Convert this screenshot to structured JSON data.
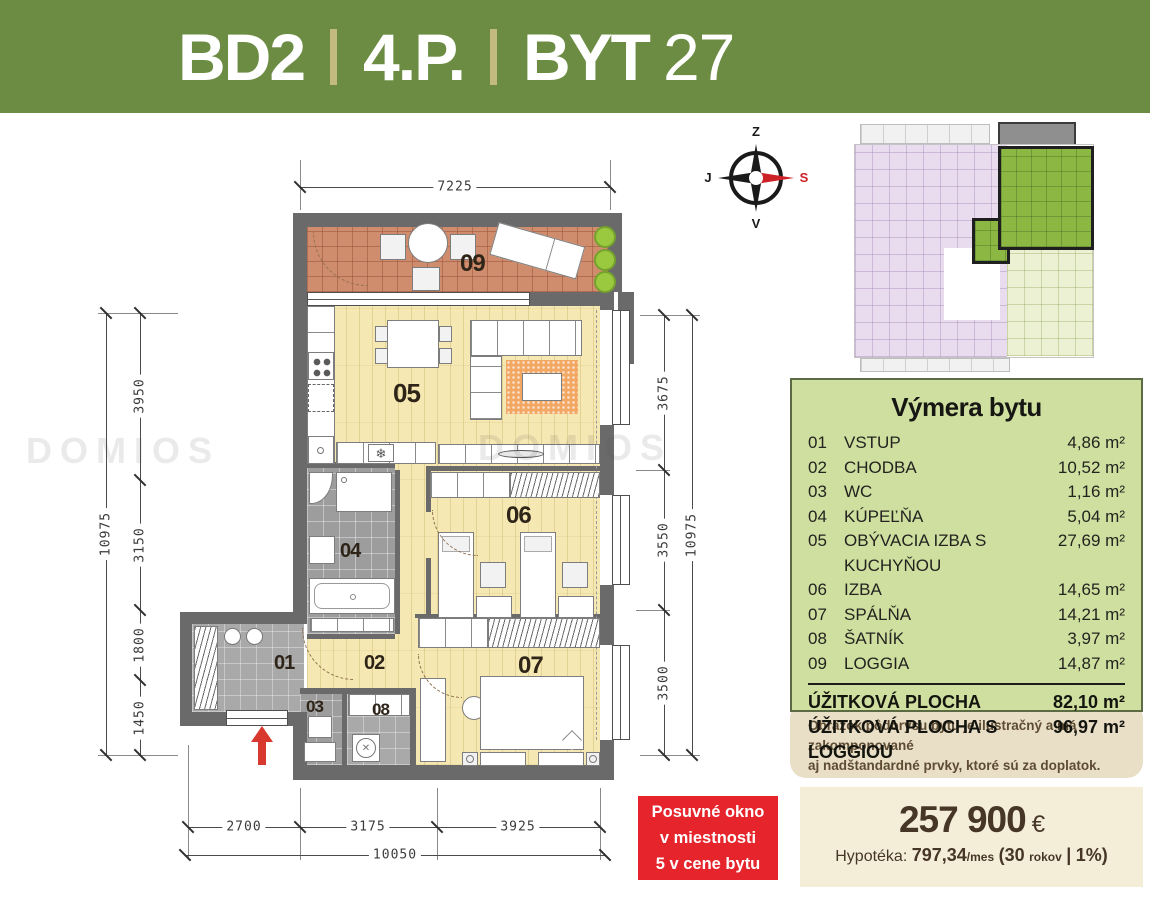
{
  "header": {
    "project": "BD2",
    "floor": "4.P.",
    "unit_type": "BYT",
    "unit_number": "27"
  },
  "compass": {
    "top": "Z",
    "bottom": "V",
    "left": "J",
    "right": "S"
  },
  "watermark": "DOMIOS",
  "area_table": {
    "title": "Výmera bytu",
    "rows": [
      {
        "num": "01",
        "name": "VSTUP",
        "area": "4,86 m²"
      },
      {
        "num": "02",
        "name": "CHODBA",
        "area": "10,52 m²"
      },
      {
        "num": "03",
        "name": "WC",
        "area": "1,16 m²"
      },
      {
        "num": "04",
        "name": "KÚPEĽŇA",
        "area": "5,04 m²"
      },
      {
        "num": "05",
        "name": "OBÝVACIA IZBA S KUCHYŇOU",
        "area": "27,69 m²"
      },
      {
        "num": "06",
        "name": "IZBA",
        "area": "14,65 m²"
      },
      {
        "num": "07",
        "name": "SPÁLŇA",
        "area": "14,21 m²"
      },
      {
        "num": "08",
        "name": "ŠATNÍK",
        "area": "3,97 m²"
      },
      {
        "num": "09",
        "name": "LOGGIA",
        "area": "14,87 m²"
      }
    ],
    "totals": [
      {
        "label": "ÚŽITKOVÁ PLOCHA",
        "area": "82,10 m²"
      },
      {
        "label": "ÚŽITKOVÁ PLOCHA S LOGGIOU",
        "area": "96,97 m²"
      }
    ]
  },
  "note": {
    "line1": "Obrázok pôdorysu bytu je ilustračný a má zakomponované",
    "line2": "aj nadštandardné prvky, ktoré sú za doplatok."
  },
  "price": {
    "amount": "257 900",
    "currency": "€",
    "mortgage": {
      "label": "Hypotéka:",
      "payment": "797,34",
      "per": "/mes",
      "open": "(",
      "years": "30",
      "years_word": "rokov",
      "sep": "|",
      "rate": "1%",
      "close": ")"
    }
  },
  "highlight": {
    "line1": "Posuvné okno",
    "line2": "v miestnosti",
    "line3": "5 v cene bytu"
  },
  "dims": {
    "top": "7225",
    "left_total": "10975",
    "left_segments": [
      "3950",
      "3150",
      "1800",
      "1450"
    ],
    "right_segments": [
      "3675",
      "3550",
      "3500"
    ],
    "right_total": "10975",
    "bottom_segments": [
      "2700",
      "3175",
      "3925"
    ],
    "bottom_total": "10050"
  },
  "plan": {
    "labels": {
      "r01": "01",
      "r02": "02",
      "r03": "03",
      "r04": "04",
      "r05": "05",
      "r06": "06",
      "r07": "07",
      "r08": "08",
      "r09": "09"
    }
  },
  "icons": {
    "snowflake": "❄",
    "wash_cross": "✕"
  },
  "colors": {
    "header_green": "#6d8c43",
    "separator_tan": "#c3ba82",
    "table_green": "#cfdf9f",
    "note_beige": "#e9dfc7",
    "price_cream": "#f4eed9",
    "accent_red": "#e5242b",
    "wall_gray": "#6a6a6a",
    "wood": "#f5e8b2",
    "loggia_tile": "#cf8d6d",
    "highlight_unit_green": "#8cb743",
    "minimap_pink": "#eadcef",
    "minimap_pale_green": "#ebf1d2",
    "rug_orange": "#f2a763",
    "plant_green": "#94c83d"
  }
}
